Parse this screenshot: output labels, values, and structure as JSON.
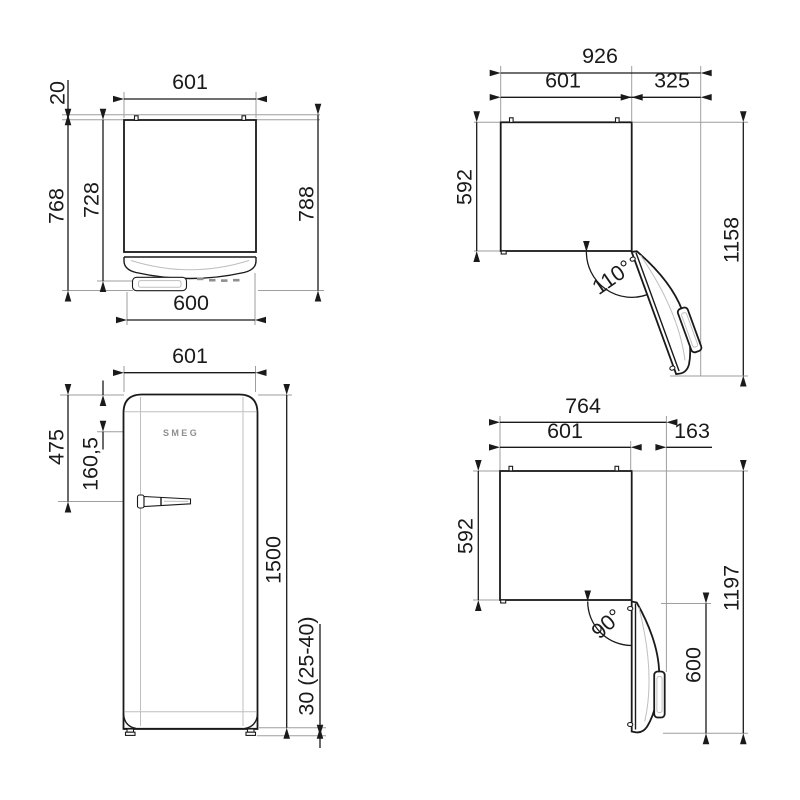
{
  "drawing": {
    "product": "refrigerator technical dimension drawing",
    "units": "mm",
    "colors": {
      "line": "#1a1a1a",
      "extension": "#9e9e9e",
      "background": "#ffffff"
    },
    "views": {
      "top_closed": {
        "name": "top view - door closed",
        "dims": {
          "width_top": "601",
          "wall_clearance": "20",
          "depth_with_door": "768",
          "depth_body": "728",
          "depth_overall": "788",
          "width_bottom": "600"
        }
      },
      "top_open_110": {
        "name": "top view - door open 110",
        "dims": {
          "overall_width": "926",
          "body_width": "601",
          "door_swing": "325",
          "depth": "592",
          "overall_depth": "1158",
          "angle": "110°"
        }
      },
      "front": {
        "name": "front view",
        "logo": "SMEG",
        "dims": {
          "width": "601",
          "handle_from_top": "475",
          "controls_from_top": "160,5",
          "height": "1500",
          "feet": "30 (25-40)"
        }
      },
      "top_open_90": {
        "name": "top view - door open 90",
        "dims": {
          "overall_width": "764",
          "body_width": "601",
          "door_swing": "163",
          "depth": "592",
          "overall_depth": "1197",
          "door_width": "600",
          "angle": "90°"
        }
      }
    }
  }
}
